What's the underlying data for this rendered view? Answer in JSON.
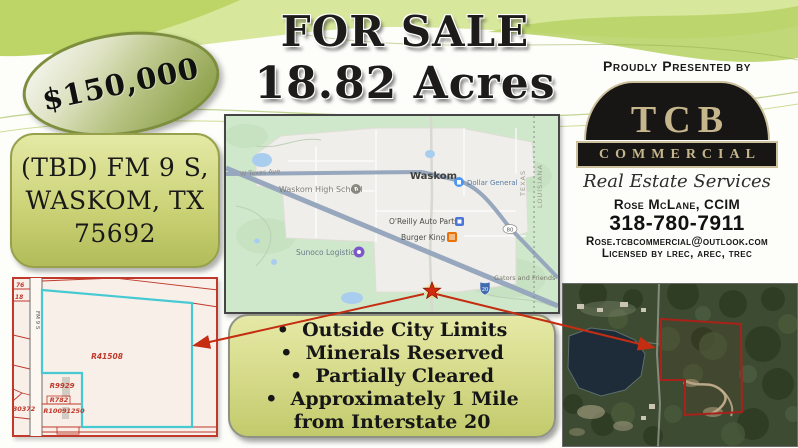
{
  "price_badge": {
    "text": "$150,000"
  },
  "headline": {
    "line1": "FOR SALE",
    "line2": "18.82 Acres"
  },
  "address_box": {
    "line1": "(TBD) FM 9 S,",
    "line2": "WASKOM, TX",
    "line3": "75692"
  },
  "presenter": {
    "heading": "Proudly Presented by",
    "logo_acronym": "TCB",
    "logo_banner": "COMMERCIAL",
    "logo_tagline": "Real Estate Services",
    "agent": "Rose McLane, CCIM",
    "phone": "318-780-7911",
    "email": "Rose.tcbcommercial@outlook.com",
    "license": "Licensed by lrec, arec, trec"
  },
  "features": {
    "items": [
      "Outside City Limits",
      "Minerals Reserved",
      "Partially Cleared",
      "Approximately 1 Mile from Interstate 20"
    ]
  },
  "map": {
    "town": "Waskom",
    "school": "Waskom High School",
    "store": "Dollar General",
    "auto_parts": "O'Reilly Auto Parts",
    "restaurant": "Burger King",
    "logistics": "Sunoco Logistics",
    "attraction": "Gators and Friends",
    "street": "W Texas Ave",
    "state_west": "TEXAS",
    "state_east": "LOUISIANA",
    "route_shield": "80",
    "interstate_shield": "20"
  },
  "plat": {
    "parcel_main": "R41508",
    "parcel_2": "R9929",
    "parcel_3": "R782",
    "parcel_4": "R10091250",
    "parcel_left": "30372",
    "parcel_top_1": "76",
    "parcel_top_2": "18",
    "road": "FM 9 S"
  },
  "colors": {
    "wave_green": "#c7dc78",
    "box_olive": "#ccd378",
    "highlight_cyan": "#47c9d3",
    "plat_red": "#c0392b",
    "arrow_red": "#c42d12",
    "logo_tan": "#c5b68c",
    "logo_black": "#171614",
    "map_green": "#cfe8cb"
  }
}
